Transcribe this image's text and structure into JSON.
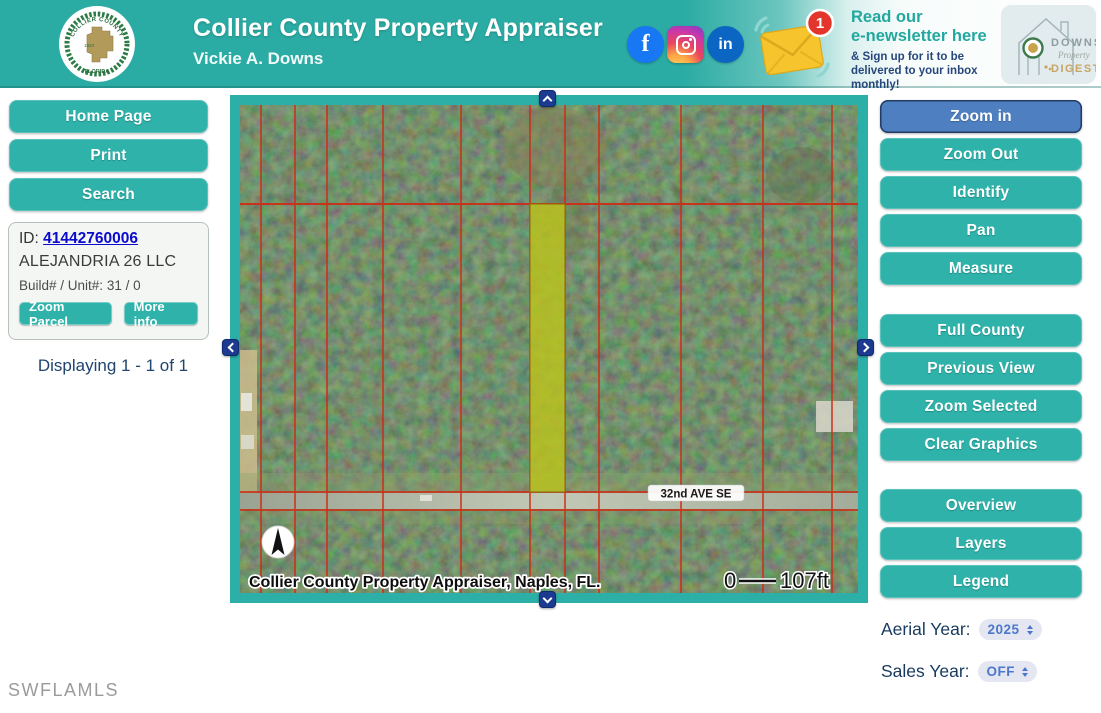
{
  "header": {
    "title": "Collier County Property Appraiser",
    "subtitle": "Vickie A. Downs",
    "seal": {
      "top_text": "COLLIER COUNTY",
      "bottom_text": "FLORIDA",
      "year": "1923"
    },
    "social": {
      "facebook": "f",
      "linkedin": "in"
    },
    "notification_count": "1",
    "newsletter": {
      "headline_line1": "Read our",
      "headline_line2": "e-newsletter here",
      "subtext": "& Sign up for it to be delivered to your inbox monthly!"
    },
    "digest_logo": {
      "word_top": "DOWNS",
      "word_script": "Property",
      "word_bottom": "DIGEST"
    }
  },
  "sidebar_left": {
    "buttons": [
      "Home Page",
      "Print",
      "Search"
    ],
    "parcel_card": {
      "id_label": "ID:",
      "id_value": "41442760006",
      "owner": "ALEJANDRIA 26 LLC",
      "build_unit_label": "Build# / Unit#:",
      "build_unit_value": "31 / 0",
      "zoom_parcel_label": "Zoom Parcel",
      "more_info_label": "More info"
    },
    "displaying_text": "Displaying 1 - 1 of 1"
  },
  "map": {
    "street_label": "32nd AVE SE",
    "caption": "Collier County Property Appraiser, Naples, FL.",
    "scale_start": "0",
    "scale_end": "107ft"
  },
  "sidebar_right": {
    "tool_buttons": [
      "Zoom in",
      "Zoom Out",
      "Identify",
      "Pan",
      "Measure"
    ],
    "active_tool": "Zoom in",
    "view_buttons": [
      "Full County",
      "Previous View",
      "Zoom Selected",
      "Clear Graphics"
    ],
    "panel_buttons": [
      "Overview",
      "Layers",
      "Legend"
    ],
    "aerial_year_label": "Aerial Year:",
    "aerial_year_value": "2025",
    "sales_year_label": "Sales Year:",
    "sales_year_value": "OFF"
  },
  "watermark": "SWFLAMLS",
  "colors": {
    "teal": "#2aaca4",
    "teal_button": "#2eb2aa",
    "active_blue": "#4d7fc1",
    "navy_arrow": "#1c3a8f",
    "parcel_line_red": "#cf2a14",
    "parcel_highlight": "#bcc41d",
    "link_blue": "#0b0bcc"
  }
}
